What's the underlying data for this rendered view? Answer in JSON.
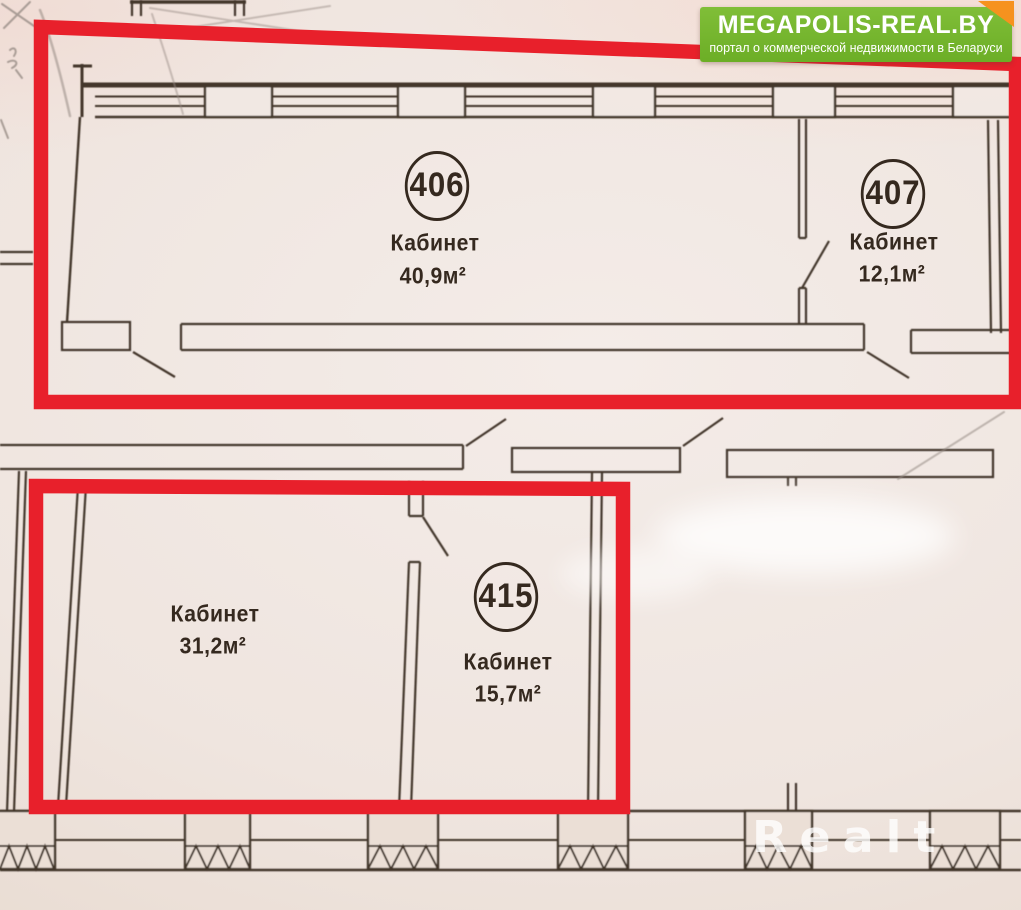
{
  "branding": {
    "logo_title": "MEGAPOLIS-REAL.BY",
    "logo_subtitle": "портал о коммерческой недвижимости в Беларуси",
    "watermark": "Realt"
  },
  "colors": {
    "highlight": "#e8202b",
    "plan_line": "#3a2d24",
    "logo_green": "#74b62e",
    "logo_orange": "#f6921e"
  },
  "rooms": [
    {
      "number": "406",
      "name": "Кабинет",
      "area": "40,9м²",
      "highlighted": true
    },
    {
      "number": "407",
      "name": "Кабинет",
      "area": "12,1м²",
      "highlighted": true
    },
    {
      "number": "415",
      "name": "Кабинет",
      "area": "15,7м²",
      "highlighted": true
    },
    {
      "number": "",
      "name": "Кабинет",
      "area": "31,2м²",
      "highlighted": true
    }
  ]
}
